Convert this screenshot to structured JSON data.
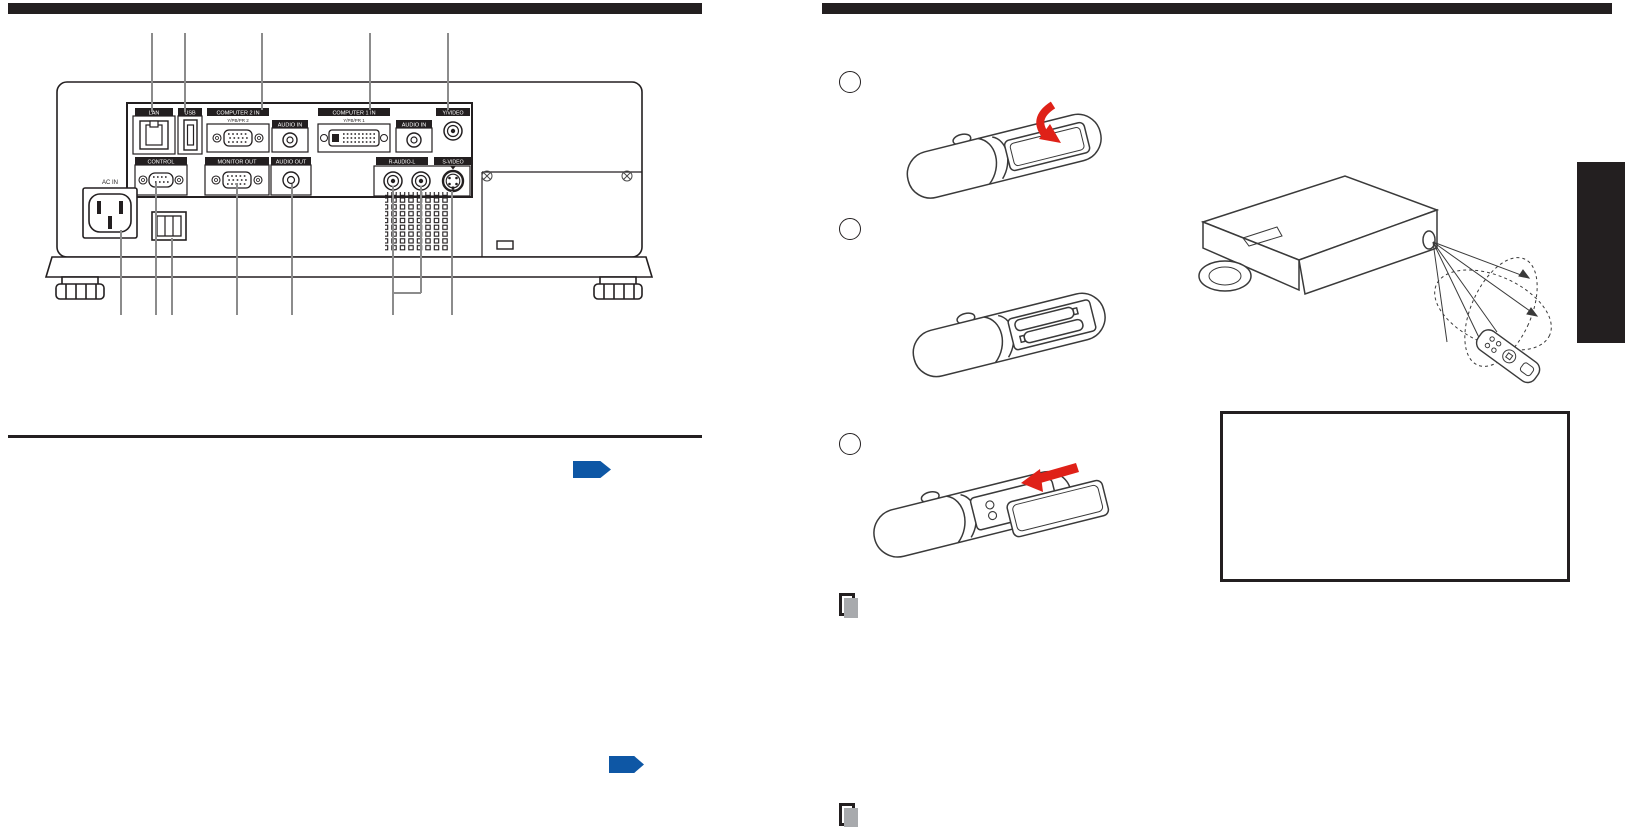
{
  "document": {
    "type": "projector-owner-manual-page",
    "header_bar_left_text": "",
    "header_bar_right_text": ""
  },
  "rear_panel": {
    "labels": {
      "lan": "LAN",
      "usb": "USB",
      "computer2": "COMPUTER 2 IN",
      "computer2_sub": "Y/PB/PR 2",
      "audio_in_1": "AUDIO IN",
      "computer1": "COMPUTER 1 IN",
      "computer1_sub": "Y/PB/PR 1",
      "audio_in_2": "AUDIO IN",
      "video": "Y/VIDEO",
      "control": "CONTROL",
      "monitor_out": "MONITOR OUT",
      "audio_out": "AUDIO OUT",
      "r_audio_l": "R-AUDIO-L",
      "s_video": "S-VIDEO",
      "ac_in": "AC IN"
    }
  },
  "steps": {
    "marker_texts": [
      "",
      "",
      ""
    ]
  },
  "icons": {
    "page_ref_arrow": "blue-right-pentagon",
    "note_memo": "gray-memo-sheets",
    "slide_arrow": "red-slide-arrow"
  },
  "colors": {
    "ink": "#231f20",
    "accent_blue": "#0e57a5",
    "arrow_red": "#df2118",
    "leader_gray": "#8c8c8c",
    "note_gray": "#a8aaad"
  }
}
